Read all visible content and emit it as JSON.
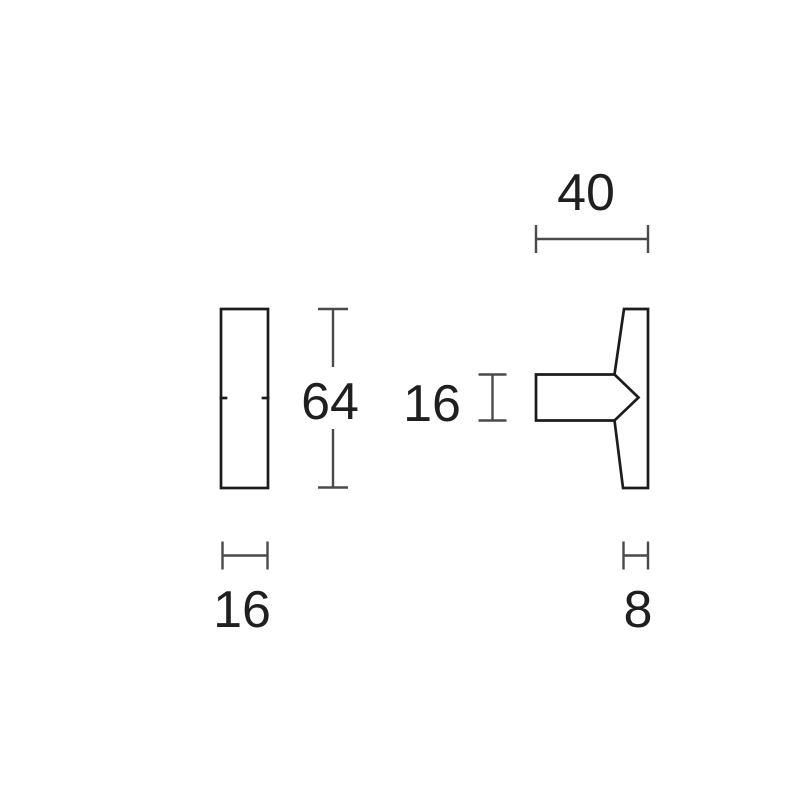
{
  "colors": {
    "background": "#ffffff",
    "outline": "#1c1c1c",
    "dimension": "#4a4a4a",
    "label": "#1f1f1f"
  },
  "drawing": {
    "type": "technical-dimension-drawing",
    "views": [
      "front-view",
      "side-profile-view"
    ],
    "unit_labels_visible": false
  },
  "dimensions": {
    "side_overall_width": "40",
    "front_height": "64",
    "stem_thickness": "16",
    "front_width": "16",
    "base_thickness": "8"
  }
}
